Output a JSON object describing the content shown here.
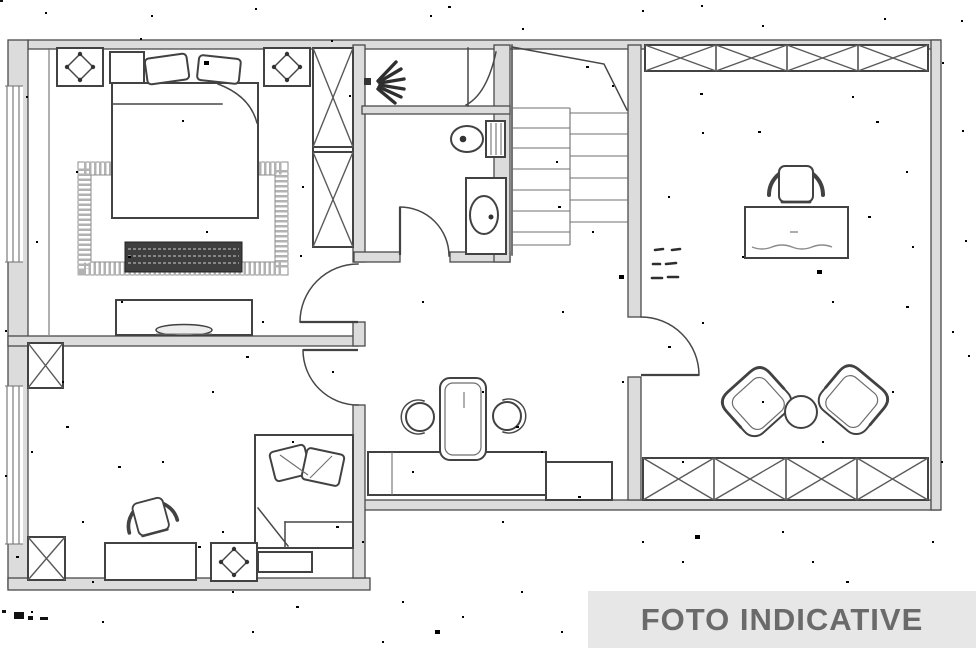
{
  "banner": {
    "label": "FOTO INDICATIVE",
    "background": "#e7e7e7",
    "text_color": "#6a6a6a"
  },
  "palette": {
    "background": "#ffffff",
    "line": "#474747",
    "wall_fill": "#dcdcdc",
    "rug_border": "#b2b2b2",
    "bench_fill": "#3e3e3e"
  },
  "plan": {
    "type": "floor-plan",
    "style": "black-and-white scanned architectural drawing with speckle noise",
    "rooms": [
      {
        "name": "bedroom-top-left",
        "contents": [
          "double-bed",
          "pillows",
          "nightstand",
          "hatched-rug",
          "dark-storage-bench",
          "dresser-with-tv",
          "tall-wardrobe-2-cells",
          "ceiling-vent-icon",
          "ceiling-vent-icon",
          "window-left",
          "door-to-hall"
        ]
      },
      {
        "name": "bathroom-top-middle",
        "contents": [
          "shower-spray-icon",
          "shower-screen-curve",
          "toilet",
          "washbasin",
          "door"
        ]
      },
      {
        "name": "staircase",
        "contents": [
          "two-stair-flights",
          "diagonal-break-line"
        ]
      },
      {
        "name": "bedroom-bottom-left",
        "contents": [
          "single-bed",
          "pillows",
          "desk",
          "office-chair",
          "nightstand",
          "ceiling-vent-icon",
          "wardrobe-cell",
          "wardrobe-cell",
          "window-left",
          "door-to-hall"
        ]
      },
      {
        "name": "living-kitchen-middle",
        "contents": [
          "dining-table",
          "stool",
          "stool",
          "kitchen-counter",
          "counter-cabinet"
        ]
      },
      {
        "name": "large-room-right",
        "contents": [
          "desk",
          "office-chair",
          "armchair",
          "armchair",
          "round-side-table",
          "balcony-railing-top",
          "balcony-railing-bottom",
          "door"
        ]
      }
    ],
    "annotations": [
      {
        "name": "stair-dimension-text",
        "lines": 3,
        "legible": false
      }
    ]
  }
}
